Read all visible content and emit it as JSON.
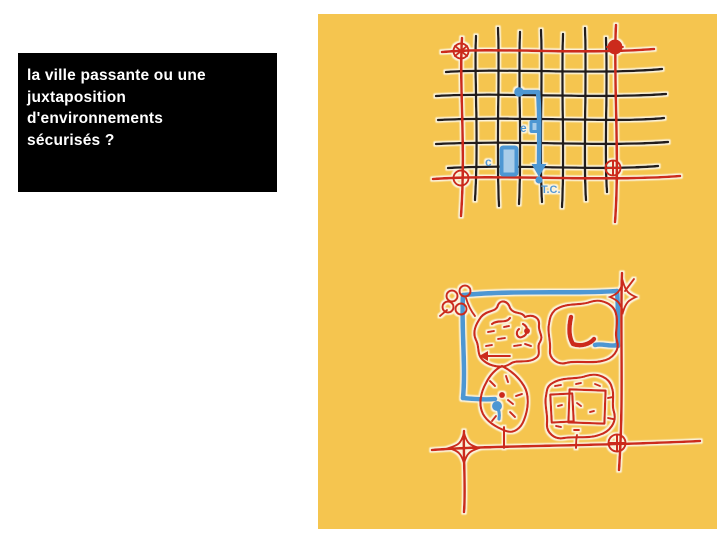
{
  "theme": {
    "slide-bg": "#ffffff",
    "title-bg": "#000000",
    "title-fg": "#ffffff",
    "panel-yellow": "#f5c54f",
    "street-black": "#201d1a",
    "road-red": "#cc2a1a",
    "transit-blue": "#4e97d3",
    "transit-blue-light": "#a9cde9",
    "halo-white": "#fcf4de"
  },
  "slide": {
    "question": "la ville passante ou une\njuxtaposition\nd'environnements\nsécurisés ?"
  },
  "sketches": {
    "grid_city": {
      "labels": {
        "entry": "e",
        "car": "c",
        "transit": "T.C."
      }
    },
    "enclave_city": {
      "labels": {}
    }
  }
}
